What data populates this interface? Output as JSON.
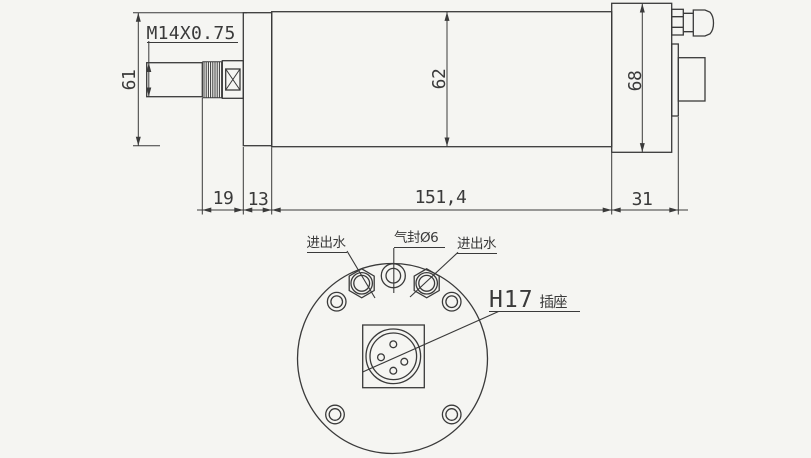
{
  "drawing": {
    "type": "spindle-motor-engineering-drawing",
    "side_view": {
      "thread_spec": "M14X0.75",
      "dimensions": {
        "nose_dia": "61",
        "body_dia": "62",
        "rear_dia": "68",
        "shaft_thread_len": "19",
        "nose_len": "13",
        "body_len": "151,4",
        "rear_len": "31"
      }
    },
    "end_view": {
      "water_port_left": "进出水",
      "air_seal_port": "气封Ø6",
      "water_port_right": "进出水",
      "socket_code": "H17",
      "socket_name": "插座"
    },
    "colors": {
      "line": "#3a3a3a",
      "background": "#f5f5f2"
    }
  }
}
